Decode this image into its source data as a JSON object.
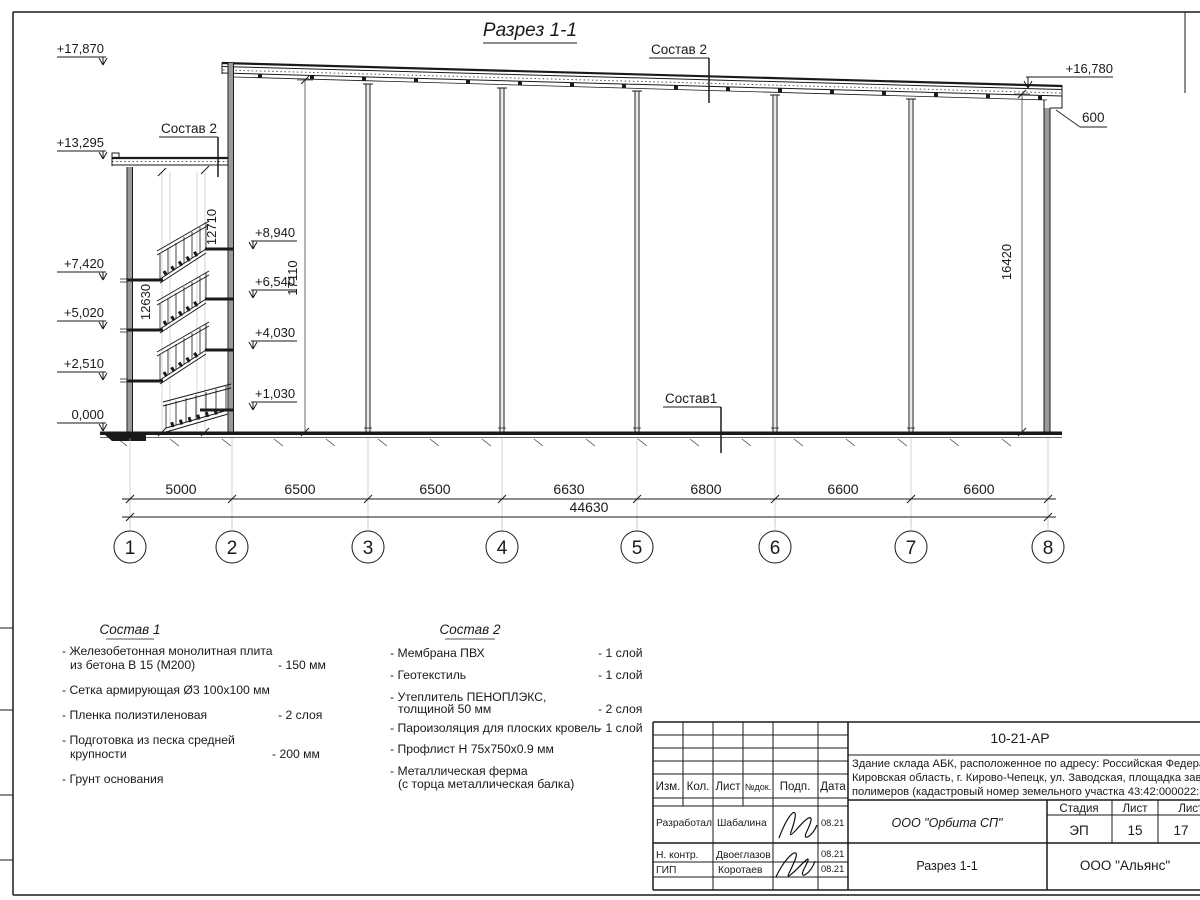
{
  "drawing": {
    "title": "Разрез 1-1",
    "el": {
      "l1": "+17,870",
      "l2": "+13,295",
      "l3": "+7,420",
      "l4": "+5,020",
      "l5": "+2,510",
      "l6": "0,000",
      "i1": "+8,940",
      "i2": "+6,540",
      "i3": "+4,030",
      "i4": "+1,030",
      "r1": "+16,780",
      "parapet": "600"
    },
    "vd": {
      "v1": "12630",
      "v2": "12710",
      "v3": "17110",
      "v4": "16420"
    },
    "ad": [
      "5000",
      "6500",
      "6500",
      "6630",
      "6800",
      "6600",
      "6600"
    ],
    "total": "44630",
    "axes": [
      "1",
      "2",
      "3",
      "4",
      "5",
      "6",
      "7",
      "8"
    ],
    "lbl": {
      "s2top": "Состав 2",
      "s2tower": "Состав 2",
      "s1": "Состав1"
    }
  },
  "notes1": {
    "title": "Состав 1",
    "i1": "- Железобетонная  монолитная плита",
    "i1b": "из бетона В 15 (М200)",
    "i1v": "- 150 мм",
    "i2": "- Сетка армирующая Ø3 100х100 мм",
    "i3": "- Пленка полиэтиленовая",
    "i3v": "-  2 слоя",
    "i4": "- Подготовка из песка средней",
    "i4b": "крупности",
    "i4v": "- 200 мм",
    "i5": "- Грунт основания"
  },
  "notes2": {
    "title": "Состав 2",
    "i1": "- Мембрана ПВХ",
    "i1v": "- 1 слой",
    "i2": "- Геотекстиль",
    "i2v": "- 1 слой",
    "i3": "- Утеплитель ПЕНОПЛЭКС,",
    "i3b": "толщиной 50 мм",
    "i3v": "- 2 слоя",
    "i4": "- Пароизоляция для плоских кровель",
    "i4v": "- 1 слой",
    "i5": "- Профлист Н 75х750х0.9 мм",
    "i6": "- Металлическая ферма",
    "i6b": "(с торца металлическая балка)"
  },
  "tb": {
    "num": "10-21-АР",
    "d1": "Здание склада АБК, расположенное по адресу: Российская Федерация,",
    "d2": "Кировская область, г. Кирово-Чепецк, ул. Заводская, площадка завода",
    "d3": "полимеров (кадастровый номер земельного участка 43:42:000022:3",
    "c1": "Изм.",
    "c2": "Кол.",
    "c3": "Лист",
    "c4": "№док.",
    "c5": "Подп.",
    "c6": "Дата",
    "r1": "Разработал",
    "r1n": "Шабалина",
    "r1d": "08.21",
    "r2": "Н. контр.",
    "r2n": "Двоеглазов",
    "r2d": "08.21",
    "r3": "ГИП",
    "r3n": "Коротаев",
    "r3d": "08.21",
    "st": "Стадия",
    "lst": "Лист",
    "lsts": "Листов",
    "stv": "ЭП",
    "lstv": "15",
    "lstsv": "17",
    "org1": "ООО \"Орбита СП\"",
    "name": "Разрез 1-1",
    "org2": "ООО \"Альянс\""
  }
}
